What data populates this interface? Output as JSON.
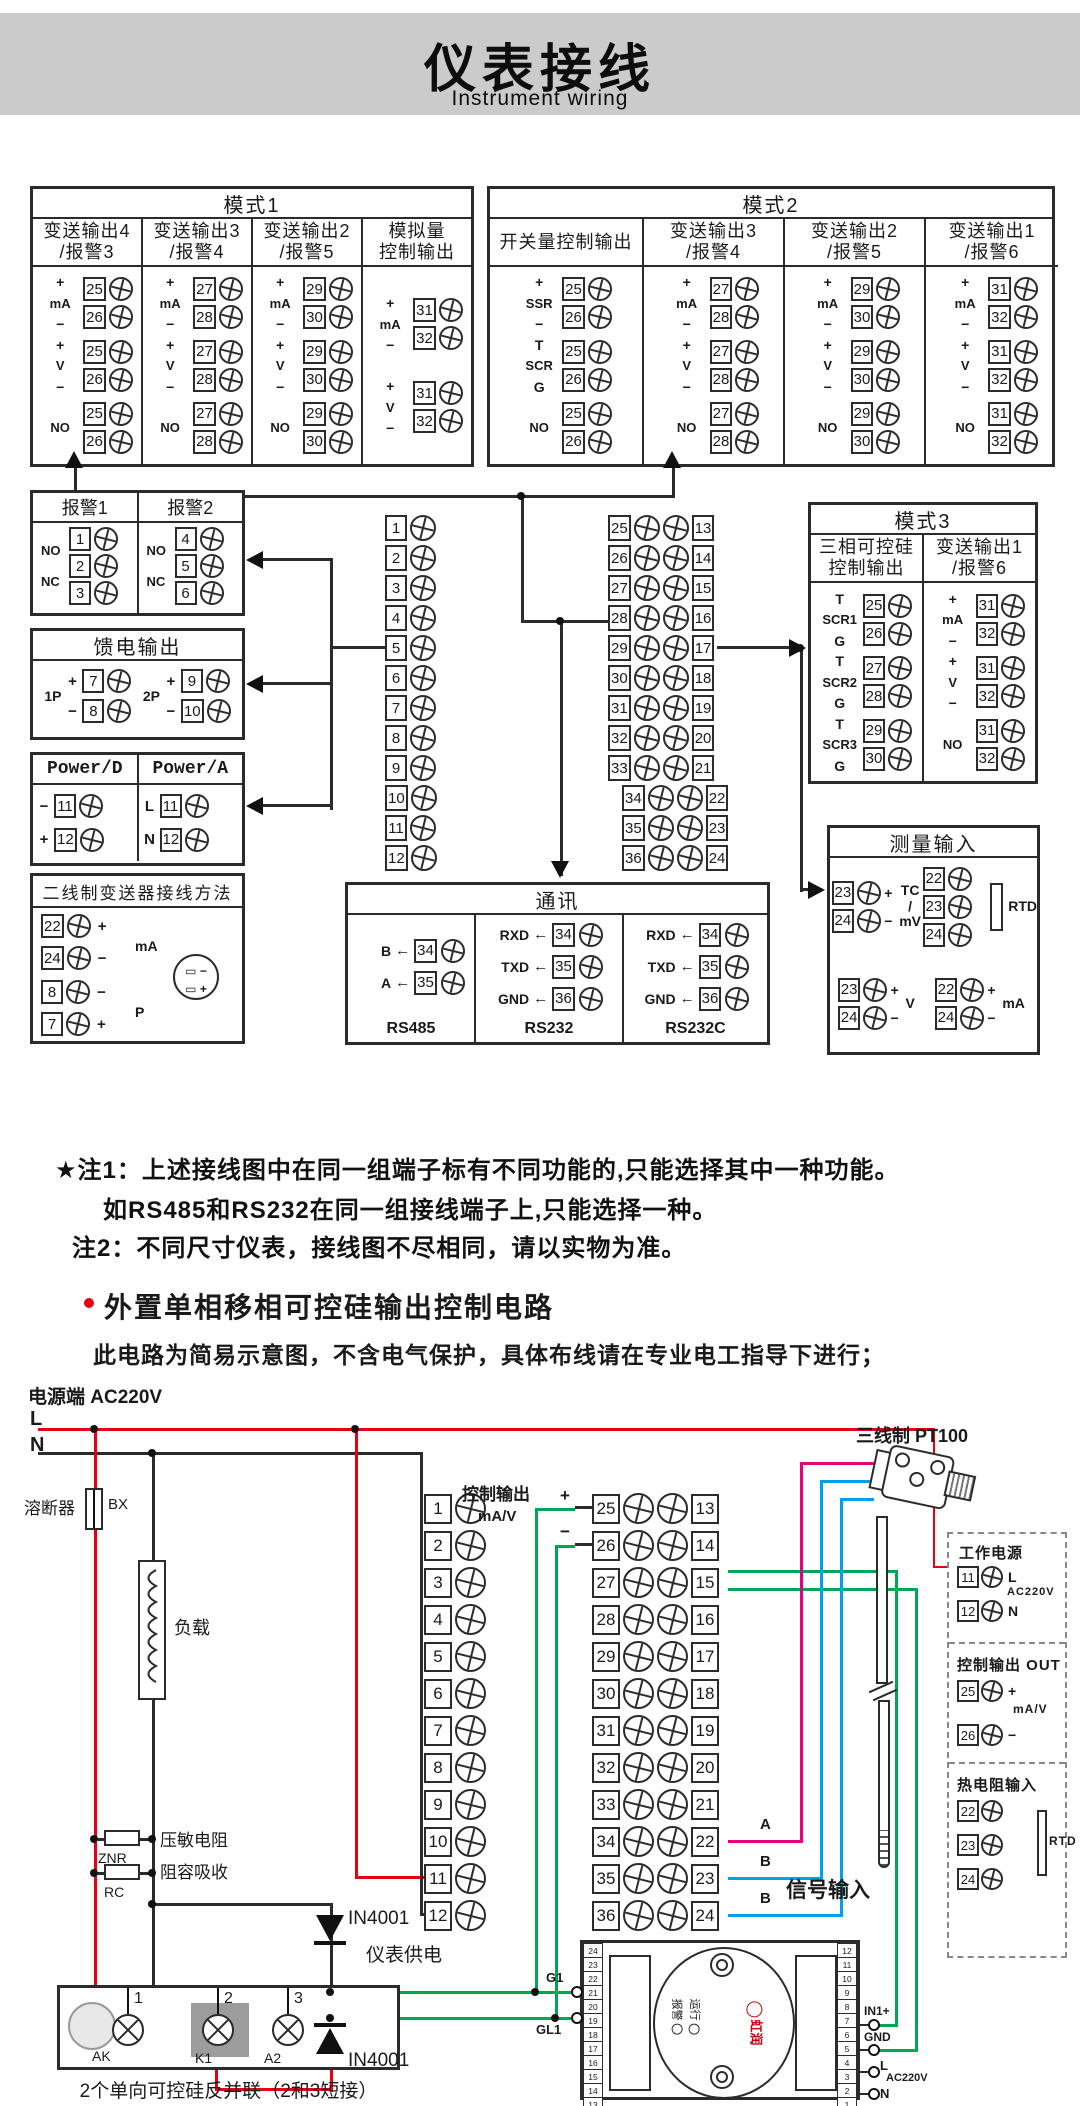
{
  "header": {
    "title": "仪表接线",
    "subtitle": "Instrument wiring"
  },
  "colors": {
    "line": "#2b2b2b",
    "red": "#e60012",
    "green": "#00a651",
    "blue": "#00a0e9",
    "magenta": "#e4007f",
    "band": "#cbcbcb",
    "gray": "#9c9c9c"
  },
  "mode1": {
    "title": "模式1",
    "columns": [
      {
        "header": "变送输出4\n/报警3",
        "groups": [
          {
            "label": "mA",
            "top": "+",
            "bottom": "−",
            "terms": [
              "25",
              "26"
            ]
          },
          {
            "label": "V",
            "top": "+",
            "bottom": "−",
            "terms": [
              "25",
              "26"
            ]
          },
          {
            "label": "NO",
            "terms": [
              "25",
              "26"
            ]
          }
        ]
      },
      {
        "header": "变送输出3\n/报警4",
        "groups": [
          {
            "label": "mA",
            "top": "+",
            "bottom": "−",
            "terms": [
              "27",
              "28"
            ]
          },
          {
            "label": "V",
            "top": "+",
            "bottom": "−",
            "terms": [
              "27",
              "28"
            ]
          },
          {
            "label": "NO",
            "terms": [
              "27",
              "28"
            ]
          }
        ]
      },
      {
        "header": "变送输出2\n/报警5",
        "groups": [
          {
            "label": "mA",
            "top": "+",
            "bottom": "−",
            "terms": [
              "29",
              "30"
            ]
          },
          {
            "label": "V",
            "top": "+",
            "bottom": "−",
            "terms": [
              "29",
              "30"
            ]
          },
          {
            "label": "NO",
            "terms": [
              "29",
              "30"
            ]
          }
        ]
      },
      {
        "header": "模拟量\n控制输出",
        "groups": [
          {
            "label": "mA",
            "top": "+",
            "bottom": "−",
            "terms": [
              "31",
              "32"
            ]
          },
          {
            "label": "V",
            "top": "+",
            "bottom": "−",
            "terms": [
              "31",
              "32"
            ]
          }
        ]
      }
    ]
  },
  "mode2": {
    "title": "模式2",
    "columns": [
      {
        "header": "开关量控制输出",
        "groups": [
          {
            "label": "SSR",
            "top": "+",
            "bottom": "−",
            "terms": [
              "25",
              "26"
            ]
          },
          {
            "label": "SCR",
            "top": "T",
            "bottom": "G",
            "terms": [
              "25",
              "26"
            ]
          },
          {
            "label": "NO",
            "terms": [
              "25",
              "26"
            ]
          }
        ]
      },
      {
        "header": "变送输出3\n/报警4",
        "groups": [
          {
            "label": "mA",
            "top": "+",
            "bottom": "−",
            "terms": [
              "27",
              "28"
            ]
          },
          {
            "label": "V",
            "top": "+",
            "bottom": "−",
            "terms": [
              "27",
              "28"
            ]
          },
          {
            "label": "NO",
            "terms": [
              "27",
              "28"
            ]
          }
        ]
      },
      {
        "header": "变送输出2\n/报警5",
        "groups": [
          {
            "label": "mA",
            "top": "+",
            "bottom": "−",
            "terms": [
              "29",
              "30"
            ]
          },
          {
            "label": "V",
            "top": "+",
            "bottom": "−",
            "terms": [
              "29",
              "30"
            ]
          },
          {
            "label": "NO",
            "terms": [
              "29",
              "30"
            ]
          }
        ]
      },
      {
        "header": "变送输出1\n/报警6",
        "groups": [
          {
            "label": "mA",
            "top": "+",
            "bottom": "−",
            "terms": [
              "31",
              "32"
            ]
          },
          {
            "label": "V",
            "top": "+",
            "bottom": "−",
            "terms": [
              "31",
              "32"
            ]
          },
          {
            "label": "NO",
            "terms": [
              "31",
              "32"
            ]
          }
        ]
      }
    ]
  },
  "mode3": {
    "title": "模式3",
    "columns": [
      {
        "header": "三相可控硅\n控制输出",
        "groups": [
          {
            "label": "SCR1",
            "top": "T",
            "bottom": "G",
            "terms": [
              "25",
              "26"
            ]
          },
          {
            "label": "SCR2",
            "top": "T",
            "bottom": "G",
            "terms": [
              "27",
              "28"
            ]
          },
          {
            "label": "SCR3",
            "top": "T",
            "bottom": "G",
            "terms": [
              "29",
              "30"
            ]
          }
        ]
      },
      {
        "header": "变送输出1\n/报警6",
        "groups": [
          {
            "label": "mA",
            "top": "+",
            "bottom": "−",
            "terms": [
              "31",
              "32"
            ]
          },
          {
            "label": "V",
            "top": "+",
            "bottom": "−",
            "terms": [
              "31",
              "32"
            ]
          },
          {
            "label": "NO",
            "terms": [
              "31",
              "32"
            ]
          }
        ]
      }
    ]
  },
  "alarm_box": {
    "cols": [
      {
        "header": "报警1",
        "tag1": "NO",
        "tag2": "NC",
        "terms": [
          "1",
          "2",
          "3"
        ]
      },
      {
        "header": "报警2",
        "tag1": "NO",
        "tag2": "NC",
        "terms": [
          "4",
          "5",
          "6"
        ]
      }
    ]
  },
  "feed_box": {
    "title": "馈电输出",
    "groups": [
      {
        "label": "1P",
        "rows": [
          {
            "sign": "+",
            "n": "7"
          },
          {
            "sign": "−",
            "n": "8"
          }
        ]
      },
      {
        "label": "2P",
        "rows": [
          {
            "sign": "+",
            "n": "9"
          },
          {
            "sign": "−",
            "n": "10"
          }
        ]
      }
    ]
  },
  "power_box": {
    "cols": [
      {
        "header": "Power/D",
        "rows": [
          {
            "sign": "−",
            "n": "11"
          },
          {
            "sign": "+",
            "n": "12"
          }
        ]
      },
      {
        "header": "Power/A",
        "rows": [
          {
            "sign": "L",
            "n": "11"
          },
          {
            "sign": "N",
            "n": "12"
          }
        ]
      }
    ]
  },
  "twowire_box": {
    "title": "二线制变送器接线方法",
    "rows": [
      {
        "n": "22",
        "sign": "+"
      },
      {
        "n": "24",
        "sign": "−"
      },
      {
        "n": "8",
        "sign": "−"
      },
      {
        "n": "7",
        "sign": "+"
      }
    ],
    "mid1": "mA",
    "mid2": "P",
    "tx_minus": "−",
    "tx_plus": "+"
  },
  "strip_left": [
    "1",
    "2",
    "3",
    "4",
    "5",
    "6",
    "7",
    "8",
    "9",
    "10",
    "11",
    "12"
  ],
  "strip_dual": [
    [
      "25",
      "13"
    ],
    [
      "26",
      "14"
    ],
    [
      "27",
      "15"
    ],
    [
      "28",
      "16"
    ],
    [
      "29",
      "17"
    ],
    [
      "30",
      "18"
    ],
    [
      "31",
      "19"
    ],
    [
      "32",
      "20"
    ],
    [
      "33",
      "21"
    ],
    [
      "34",
      "22"
    ],
    [
      "35",
      "23"
    ],
    [
      "36",
      "24"
    ]
  ],
  "comm_box": {
    "title": "通讯",
    "arrow": "←",
    "sections": [
      {
        "caption": "RS485",
        "rows": [
          {
            "label": "B",
            "n": "34"
          },
          {
            "label": "A",
            "n": "35"
          }
        ]
      },
      {
        "caption": "RS232",
        "rows": [
          {
            "label": "RXD",
            "n": "34"
          },
          {
            "label": "TXD",
            "n": "35"
          },
          {
            "label": "GND",
            "n": "36"
          }
        ]
      },
      {
        "caption": "RS232C",
        "rows": [
          {
            "label": "RXD",
            "n": "34"
          },
          {
            "label": "TXD",
            "n": "35"
          },
          {
            "label": "GND",
            "n": "36"
          }
        ]
      }
    ]
  },
  "measure_box": {
    "title": "测量输入",
    "groups": [
      {
        "label": "TC\n/\nmV",
        "rows": [
          {
            "n": "23",
            "sign": "+"
          },
          {
            "n": "24",
            "sign": "−"
          }
        ]
      },
      {
        "label": "RTD",
        "rows": [
          {
            "n": "22"
          },
          {
            "n": "23"
          },
          {
            "n": "24"
          }
        ]
      },
      {
        "label": "V",
        "rows": [
          {
            "n": "23",
            "sign": "+"
          },
          {
            "n": "24",
            "sign": "−"
          }
        ]
      },
      {
        "label": "mA",
        "rows": [
          {
            "n": "22",
            "sign": "+"
          },
          {
            "n": "24",
            "sign": "−"
          }
        ]
      }
    ]
  },
  "notes": {
    "note1": "★注1：上述接线图中在同一组端子标有不同功能的,只能选择其中一种功能。",
    "note1b": "如RS485和RS232在同一组接线端子上,只能选择一种。",
    "note2": "注2：不同尺寸仪表，接线图不尽相同，请以实物为准。"
  },
  "section2": {
    "title": "外置单相移相可控硅输出控制电路",
    "warning": "此电路为简易示意图，不含电气保护，具体布线请在专业电工指导下进行；"
  },
  "circuit": {
    "source": "电源端 AC220V",
    "l": "L",
    "n": "N",
    "fuse": "溶断器",
    "bx": "BX",
    "load": "负载",
    "varistor": "压敏电阻",
    "znr": "ZNR",
    "rc_name": "阻容吸收",
    "rc": "RC",
    "meter_supply": "仪表供电",
    "ctrl_out": "控制输出",
    "plus": "+",
    "mav": "mA/V",
    "minus": "−",
    "a": "A",
    "b1": "B",
    "b2": "B",
    "sig_in": "信号输入",
    "pt100": "三线制 PT100",
    "d1": "IN4001",
    "d2": "IN4001",
    "scr_block": {
      "n1": "1",
      "n2": "2",
      "n3": "3",
      "ak": "AK",
      "k1": "K1",
      "a2": "A2",
      "caption": "2个单向可控硅反并联（2和3短接）"
    },
    "panel": {
      "work": "工作电源",
      "w1": "11",
      "wl": "L",
      "ac1": "AC220V",
      "w2": "12",
      "wn": "N",
      "out": "控制输出 OUT",
      "o1": "25",
      "op": "+",
      "omav": "mA/V",
      "o2": "26",
      "om": "−",
      "rtd_t": "热电阻输入",
      "r1": "22",
      "r2": "23",
      "r3": "24",
      "rtd": "RTD"
    },
    "trigger": {
      "left": [
        "24",
        "23",
        "22",
        "21",
        "20",
        "19",
        "18",
        "17",
        "16",
        "15",
        "14",
        "13"
      ],
      "right": [
        "12",
        "11",
        "10",
        "9",
        "8",
        "7",
        "6",
        "5",
        "4",
        "3",
        "2",
        "1"
      ],
      "g1": "G1",
      "gl1": "GL1",
      "in1": "IN1+",
      "gnd": "GND",
      "l": "L",
      "ac": "AC220V",
      "n": "N",
      "run": "运行",
      "alarm": "报警",
      "brand": "虹润"
    }
  }
}
